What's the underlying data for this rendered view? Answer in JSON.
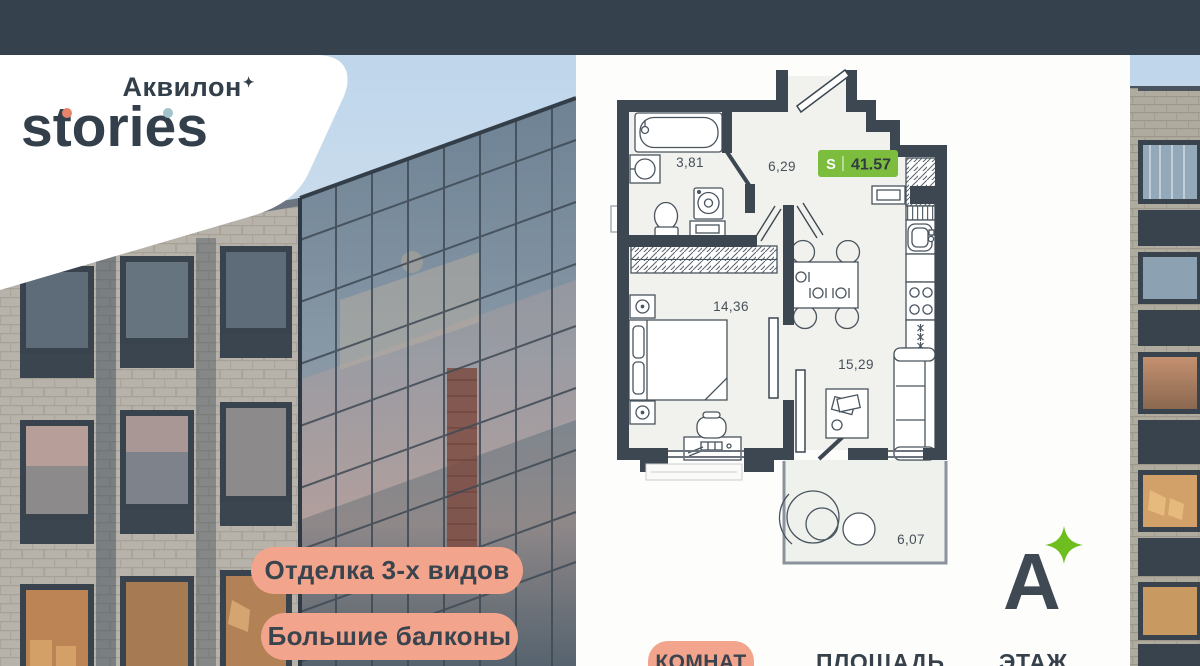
{
  "brand": {
    "line1": "Аквилон",
    "sparkle": "✦",
    "line2": "stories"
  },
  "photo_badges": [
    {
      "label": "Отделка 3-х видов"
    },
    {
      "label": "Большие балконы"
    }
  ],
  "floor_plan": {
    "total": {
      "label": "S",
      "value": "41.57"
    },
    "rooms": {
      "bathroom": "3,81",
      "hallway": "6,29",
      "bedroom": "14,36",
      "kitchen_living": "15,29",
      "balcony": "6,07"
    }
  },
  "footer": {
    "rooms_label": "КОМНАТ",
    "area_label": "ПЛОЩАДЬ",
    "floor_label": "ЭТАЖ"
  },
  "logo_mark": {
    "letter": "А"
  },
  "colors": {
    "top_band": "#35414C",
    "wall_slate": "#3C4751",
    "accent_green": "#7CBD3E",
    "accent_salmon": "#F2A48D",
    "plan_room_fill": "#F1F2EE",
    "sky_top": "#BFD6EB"
  }
}
